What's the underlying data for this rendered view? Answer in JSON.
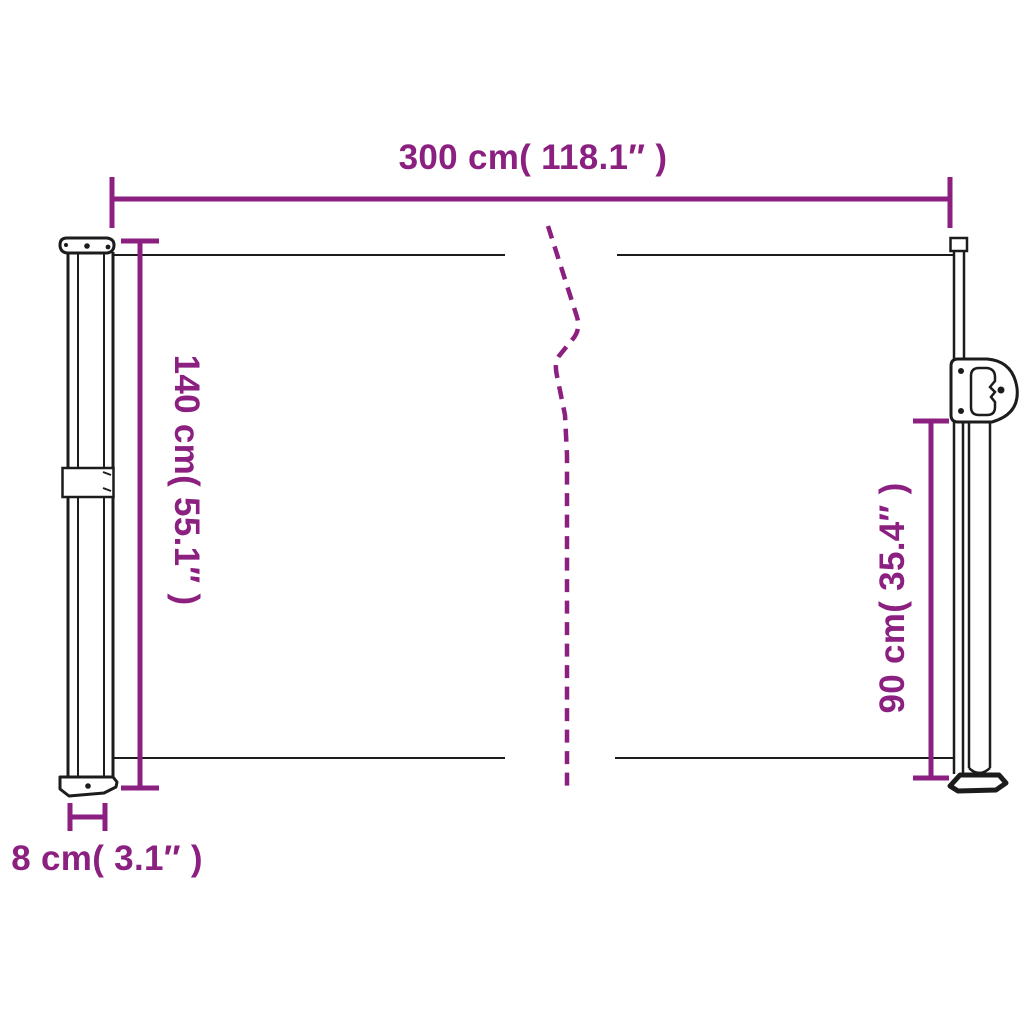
{
  "diagram": {
    "title": "retractable side awning dimension diagram",
    "dimensions": {
      "width": {
        "label": "300 cm( 118.1″ )"
      },
      "height_left": {
        "label": "140 cm( 55.1″ )"
      },
      "height_right": {
        "label": "90 cm( 35.4″ )"
      },
      "cassette_depth": {
        "label": "8 cm( 3.1″ )"
      }
    }
  },
  "colors": {
    "dimension_accent": "#8B2080",
    "line_art": "#1c1c1c",
    "background": "#ffffff"
  }
}
